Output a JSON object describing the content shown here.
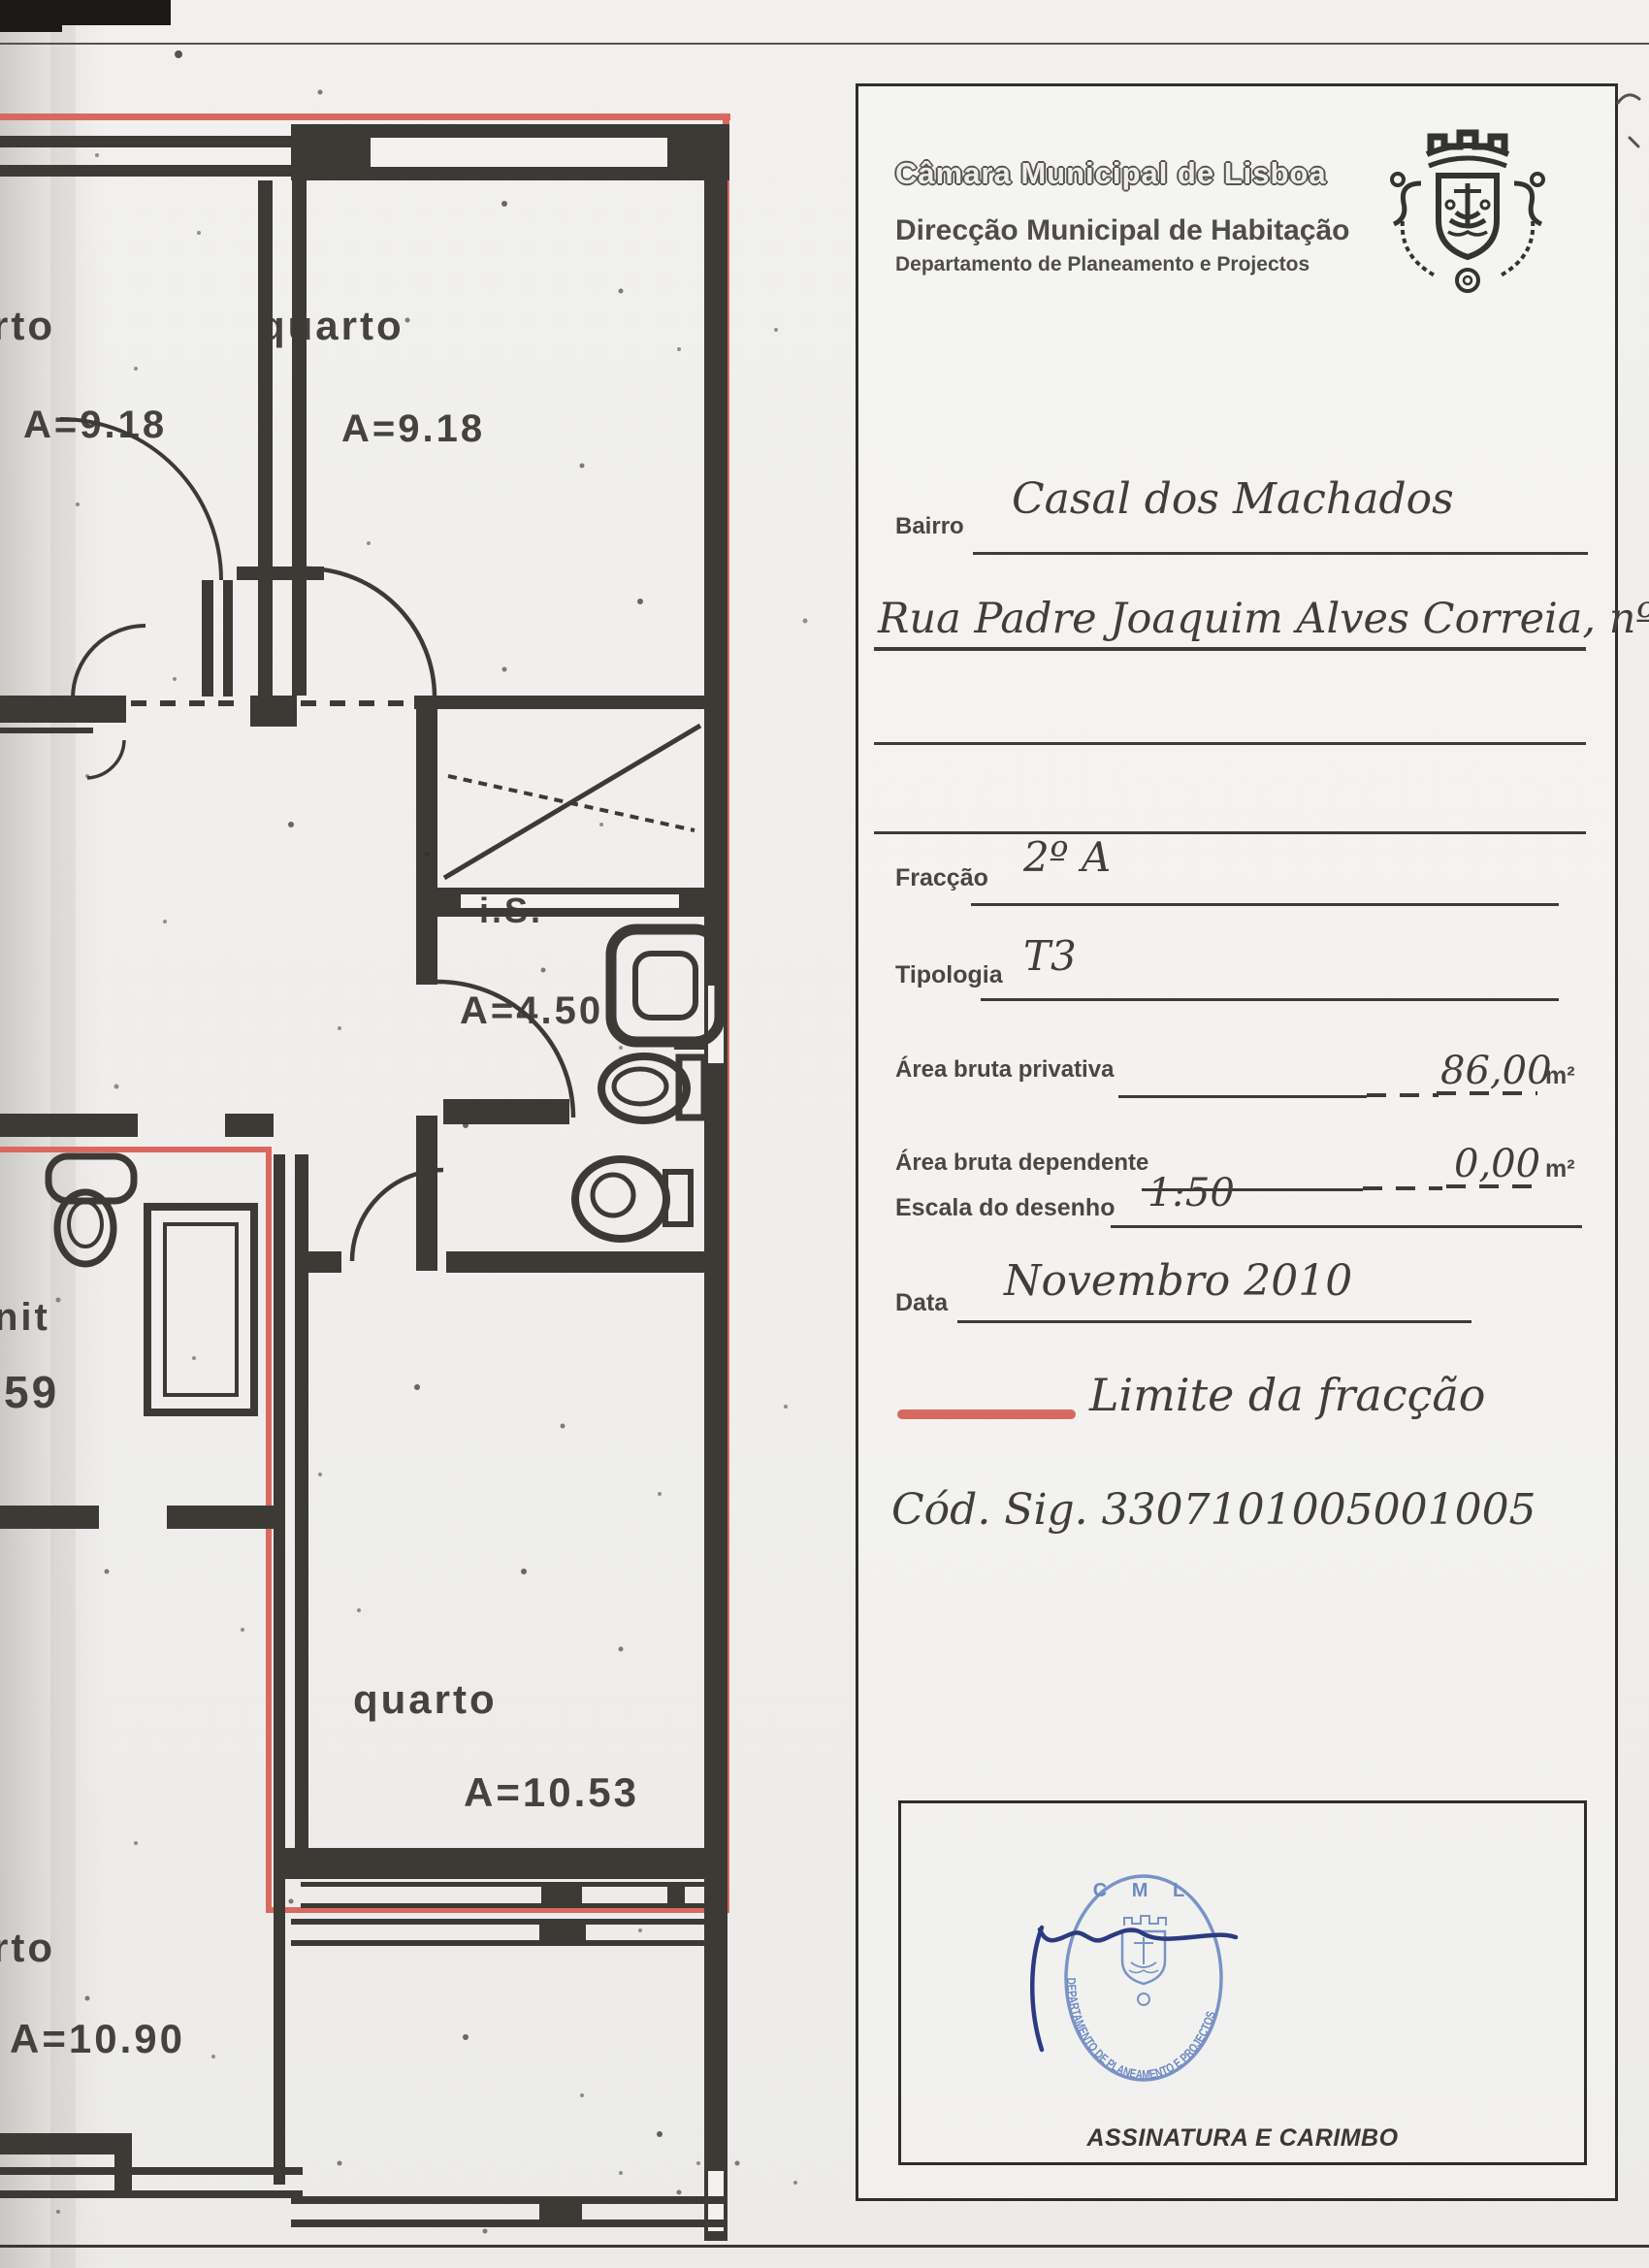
{
  "colors": {
    "wall": "#3d3a35",
    "boundary": "#d9695f",
    "ink": "#45423d",
    "stamp-blue": "#6d89c2",
    "signature-blue": "#2d3a82"
  },
  "form": {
    "header": {
      "org": "Câmara Municipal de Lisboa",
      "direction": "Direcção Municipal de Habitação",
      "department": "Departamento de Planeamento e Projectos"
    },
    "bairro": {
      "label": "Bairro",
      "value": "Casal dos Machados"
    },
    "address": {
      "value": "Rua Padre Joaquim Alves Correia, nº 6"
    },
    "fraccao": {
      "label": "Fracção",
      "value": "2º A"
    },
    "tipologia": {
      "label": "Tipologia",
      "value": "T3"
    },
    "area_bruta_privativa": {
      "label": "Área bruta privativa",
      "value": "86,00",
      "unit": "m²"
    },
    "area_bruta_dependente": {
      "label": "Área bruta dependente",
      "value": "0,00",
      "unit": "m²"
    },
    "escala": {
      "label": "Escala do desenho",
      "value": "1:50"
    },
    "data": {
      "label": "Data",
      "value": "Novembro 2010"
    },
    "legend": {
      "label": "Limite da fracção"
    },
    "cod_sig": "Cód. Sig. 3307101005001005",
    "signature": {
      "box_label": "ASSINATURA E CARIMBO",
      "stamp_top": "C M L",
      "stamp_ring": "DEPARTAMENTO DE PLANEAMENTO E PROJECTOS"
    }
  },
  "plan": {
    "labels": [
      {
        "text": "rto"
      },
      {
        "text": "A=9.18"
      },
      {
        "text": "quarto"
      },
      {
        "text": "A=9.18"
      },
      {
        "text": "i.S."
      },
      {
        "text": "A=4.50"
      },
      {
        "text": "nit"
      },
      {
        "text": "59"
      },
      {
        "text": "quarto"
      },
      {
        "text": "A=10.53"
      },
      {
        "text": "rto"
      },
      {
        "text": "A=10.90"
      }
    ]
  }
}
